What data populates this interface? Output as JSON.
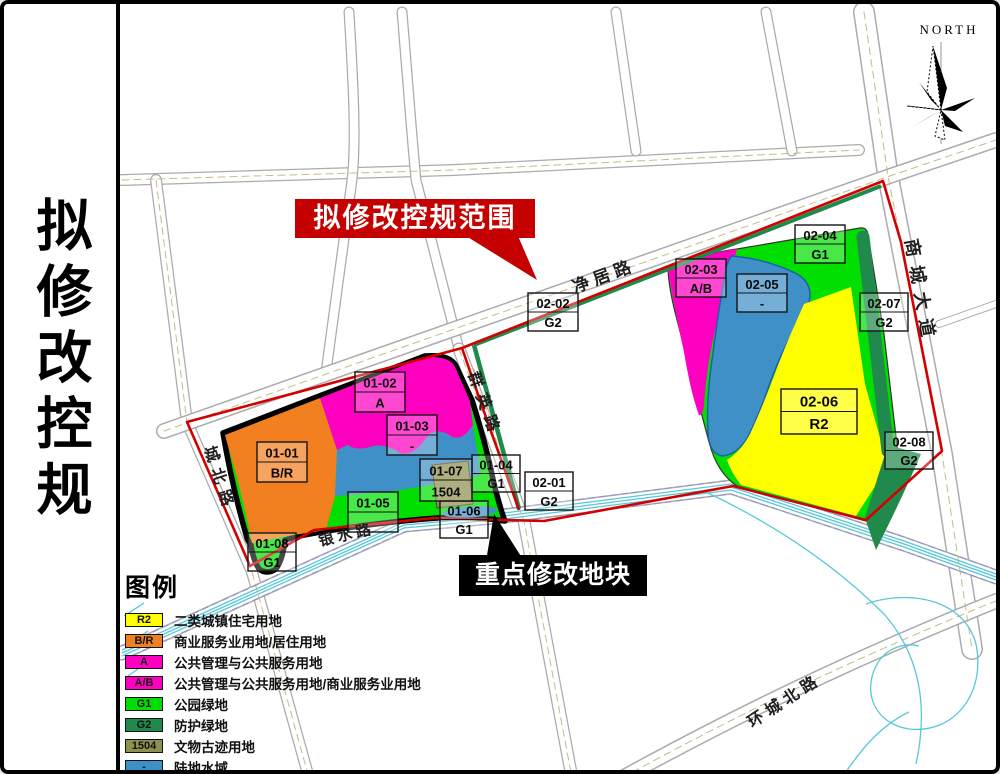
{
  "sidebar": {
    "title": "拟修改控规"
  },
  "north": {
    "label": "NORTH"
  },
  "banners": {
    "scope": "拟修改控规范围",
    "key_parcel": "重点修改地块"
  },
  "roads": [
    "净居路",
    "商城大道",
    "群英路",
    "城北路",
    "银水路",
    "环城北路"
  ],
  "parcels": [
    {
      "code": "01-01",
      "zone": "B/R"
    },
    {
      "code": "01-02",
      "zone": "A"
    },
    {
      "code": "01-03",
      "zone": "-"
    },
    {
      "code": "01-04",
      "zone": "G1"
    },
    {
      "code": "01-05",
      "zone": ""
    },
    {
      "code": "01-06",
      "zone": "G1"
    },
    {
      "code": "01-07",
      "zone": "1504"
    },
    {
      "code": "01-08",
      "zone": "G1"
    },
    {
      "code": "02-01",
      "zone": "G2"
    },
    {
      "code": "02-02",
      "zone": "G2"
    },
    {
      "code": "02-03",
      "zone": "A/B"
    },
    {
      "code": "02-04",
      "zone": "G1"
    },
    {
      "code": "02-05",
      "zone": "-"
    },
    {
      "code": "02-06",
      "zone": "R2"
    },
    {
      "code": "02-07",
      "zone": "G2"
    },
    {
      "code": "02-08",
      "zone": "G2"
    }
  ],
  "legend": {
    "title": "图例",
    "items": [
      {
        "code": "R2",
        "label": "二类城镇住宅用地",
        "color": "#ffff00"
      },
      {
        "code": "B/R",
        "label": "商业服务业用地/居住用地",
        "color": "#f28020"
      },
      {
        "code": "A",
        "label": "公共管理与公共服务用地",
        "color": "#ff00c0"
      },
      {
        "code": "A/B",
        "label": "公共管理与公共服务用地/商业服务业用地",
        "color": "#ff00c0"
      },
      {
        "code": "G1",
        "label": "公园绿地",
        "color": "#00df00"
      },
      {
        "code": "G2",
        "label": "防护绿地",
        "color": "#1f8a4c"
      },
      {
        "code": "1504",
        "label": "文物古迹用地",
        "color": "#8f9151"
      },
      {
        "code": "-",
        "label": "陆地水域",
        "color": "#4090c8"
      }
    ]
  },
  "colors": {
    "boundary_red": "#d40000",
    "banner_red": "#c40000",
    "banner_black": "#000000",
    "cluster_outline": "#000000",
    "water_line": "#58c8d8"
  }
}
